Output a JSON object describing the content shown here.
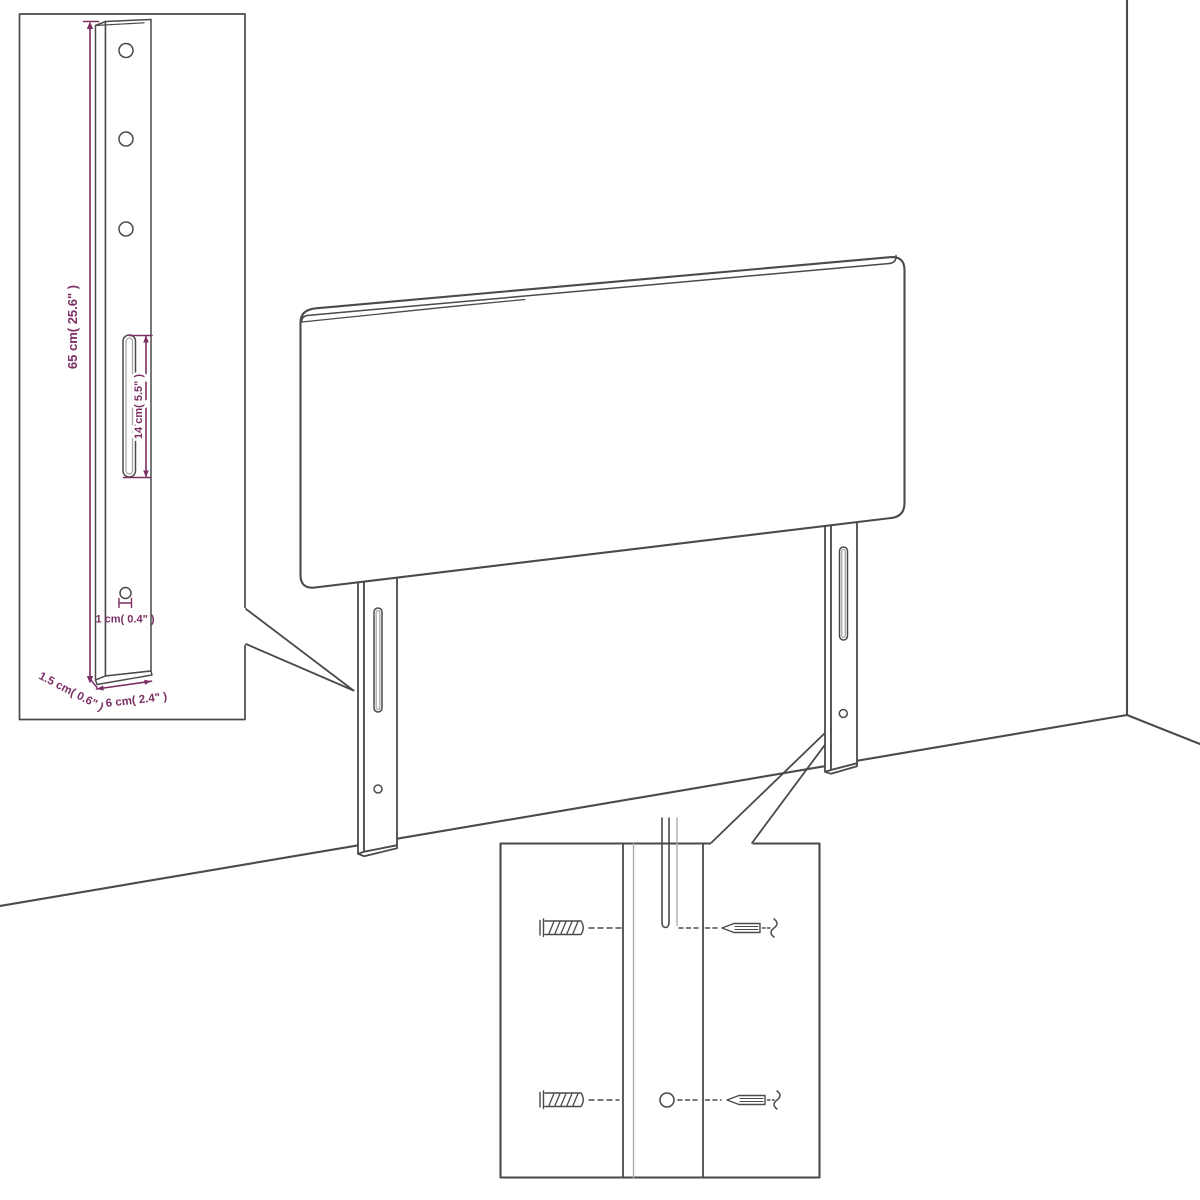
{
  "colors": {
    "background": "#ffffff",
    "line": "#4a4a4a",
    "line_light": "#a8a8a8",
    "dimension": "#7c2f64"
  },
  "post_detail": {
    "height_label": "65 cm( 25.6\" )",
    "slot_height_label": "14 cm( 5.5\" )",
    "hole_diameter_label": "1 cm( 0.4\" )",
    "thickness_label": "1.5 cm( 0.6\" )",
    "width_label": "6 cm( 2.4\" )"
  }
}
